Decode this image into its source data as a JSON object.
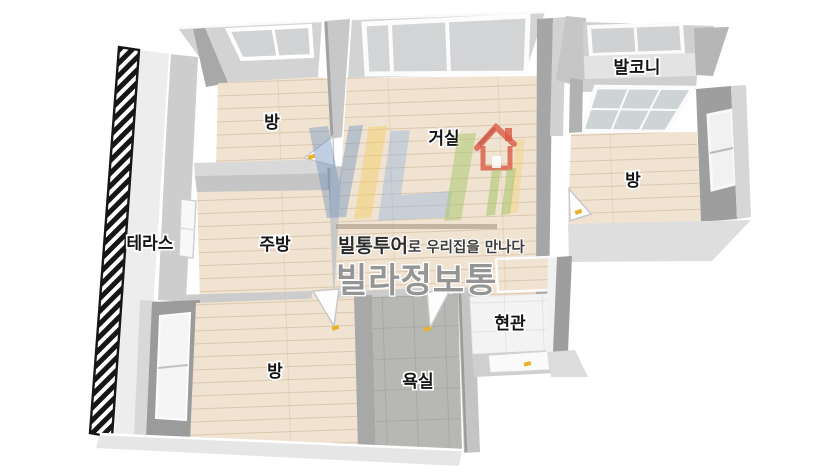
{
  "floorplan": {
    "type": "3d-floorplan",
    "rooms": [
      {
        "id": "terrace",
        "label": "테라스"
      },
      {
        "id": "bedroom-top-left",
        "label": "방"
      },
      {
        "id": "living-room",
        "label": "거실"
      },
      {
        "id": "balcony",
        "label": "발코니"
      },
      {
        "id": "bedroom-right",
        "label": "방"
      },
      {
        "id": "kitchen",
        "label": "주방"
      },
      {
        "id": "bedroom-bottom-left",
        "label": "방"
      },
      {
        "id": "bathroom",
        "label": "욕실"
      },
      {
        "id": "entrance",
        "label": "현관"
      }
    ],
    "colors": {
      "floor_wood": "#f1e3d1",
      "wall_light": "#d3d3d3",
      "wall_dark": "#a4a4a4",
      "bathroom_tile": "#b7b7b4",
      "entrance_tile": "#f3f3f3",
      "terrace_railing": "#151515",
      "door_marker_yellow": "#e8b32a"
    }
  },
  "watermark": {
    "tagline_brand": "빌통투어",
    "tagline_suffix": "로 우리집을 만나다",
    "title": "빌라정보통",
    "logo_colors": {
      "blue": "#7394c0",
      "light_blue": "#98b6dd",
      "yellow": "#f2ce6a",
      "green": "#a8c46c",
      "red": "#db5a46",
      "gray": "#868686"
    }
  }
}
